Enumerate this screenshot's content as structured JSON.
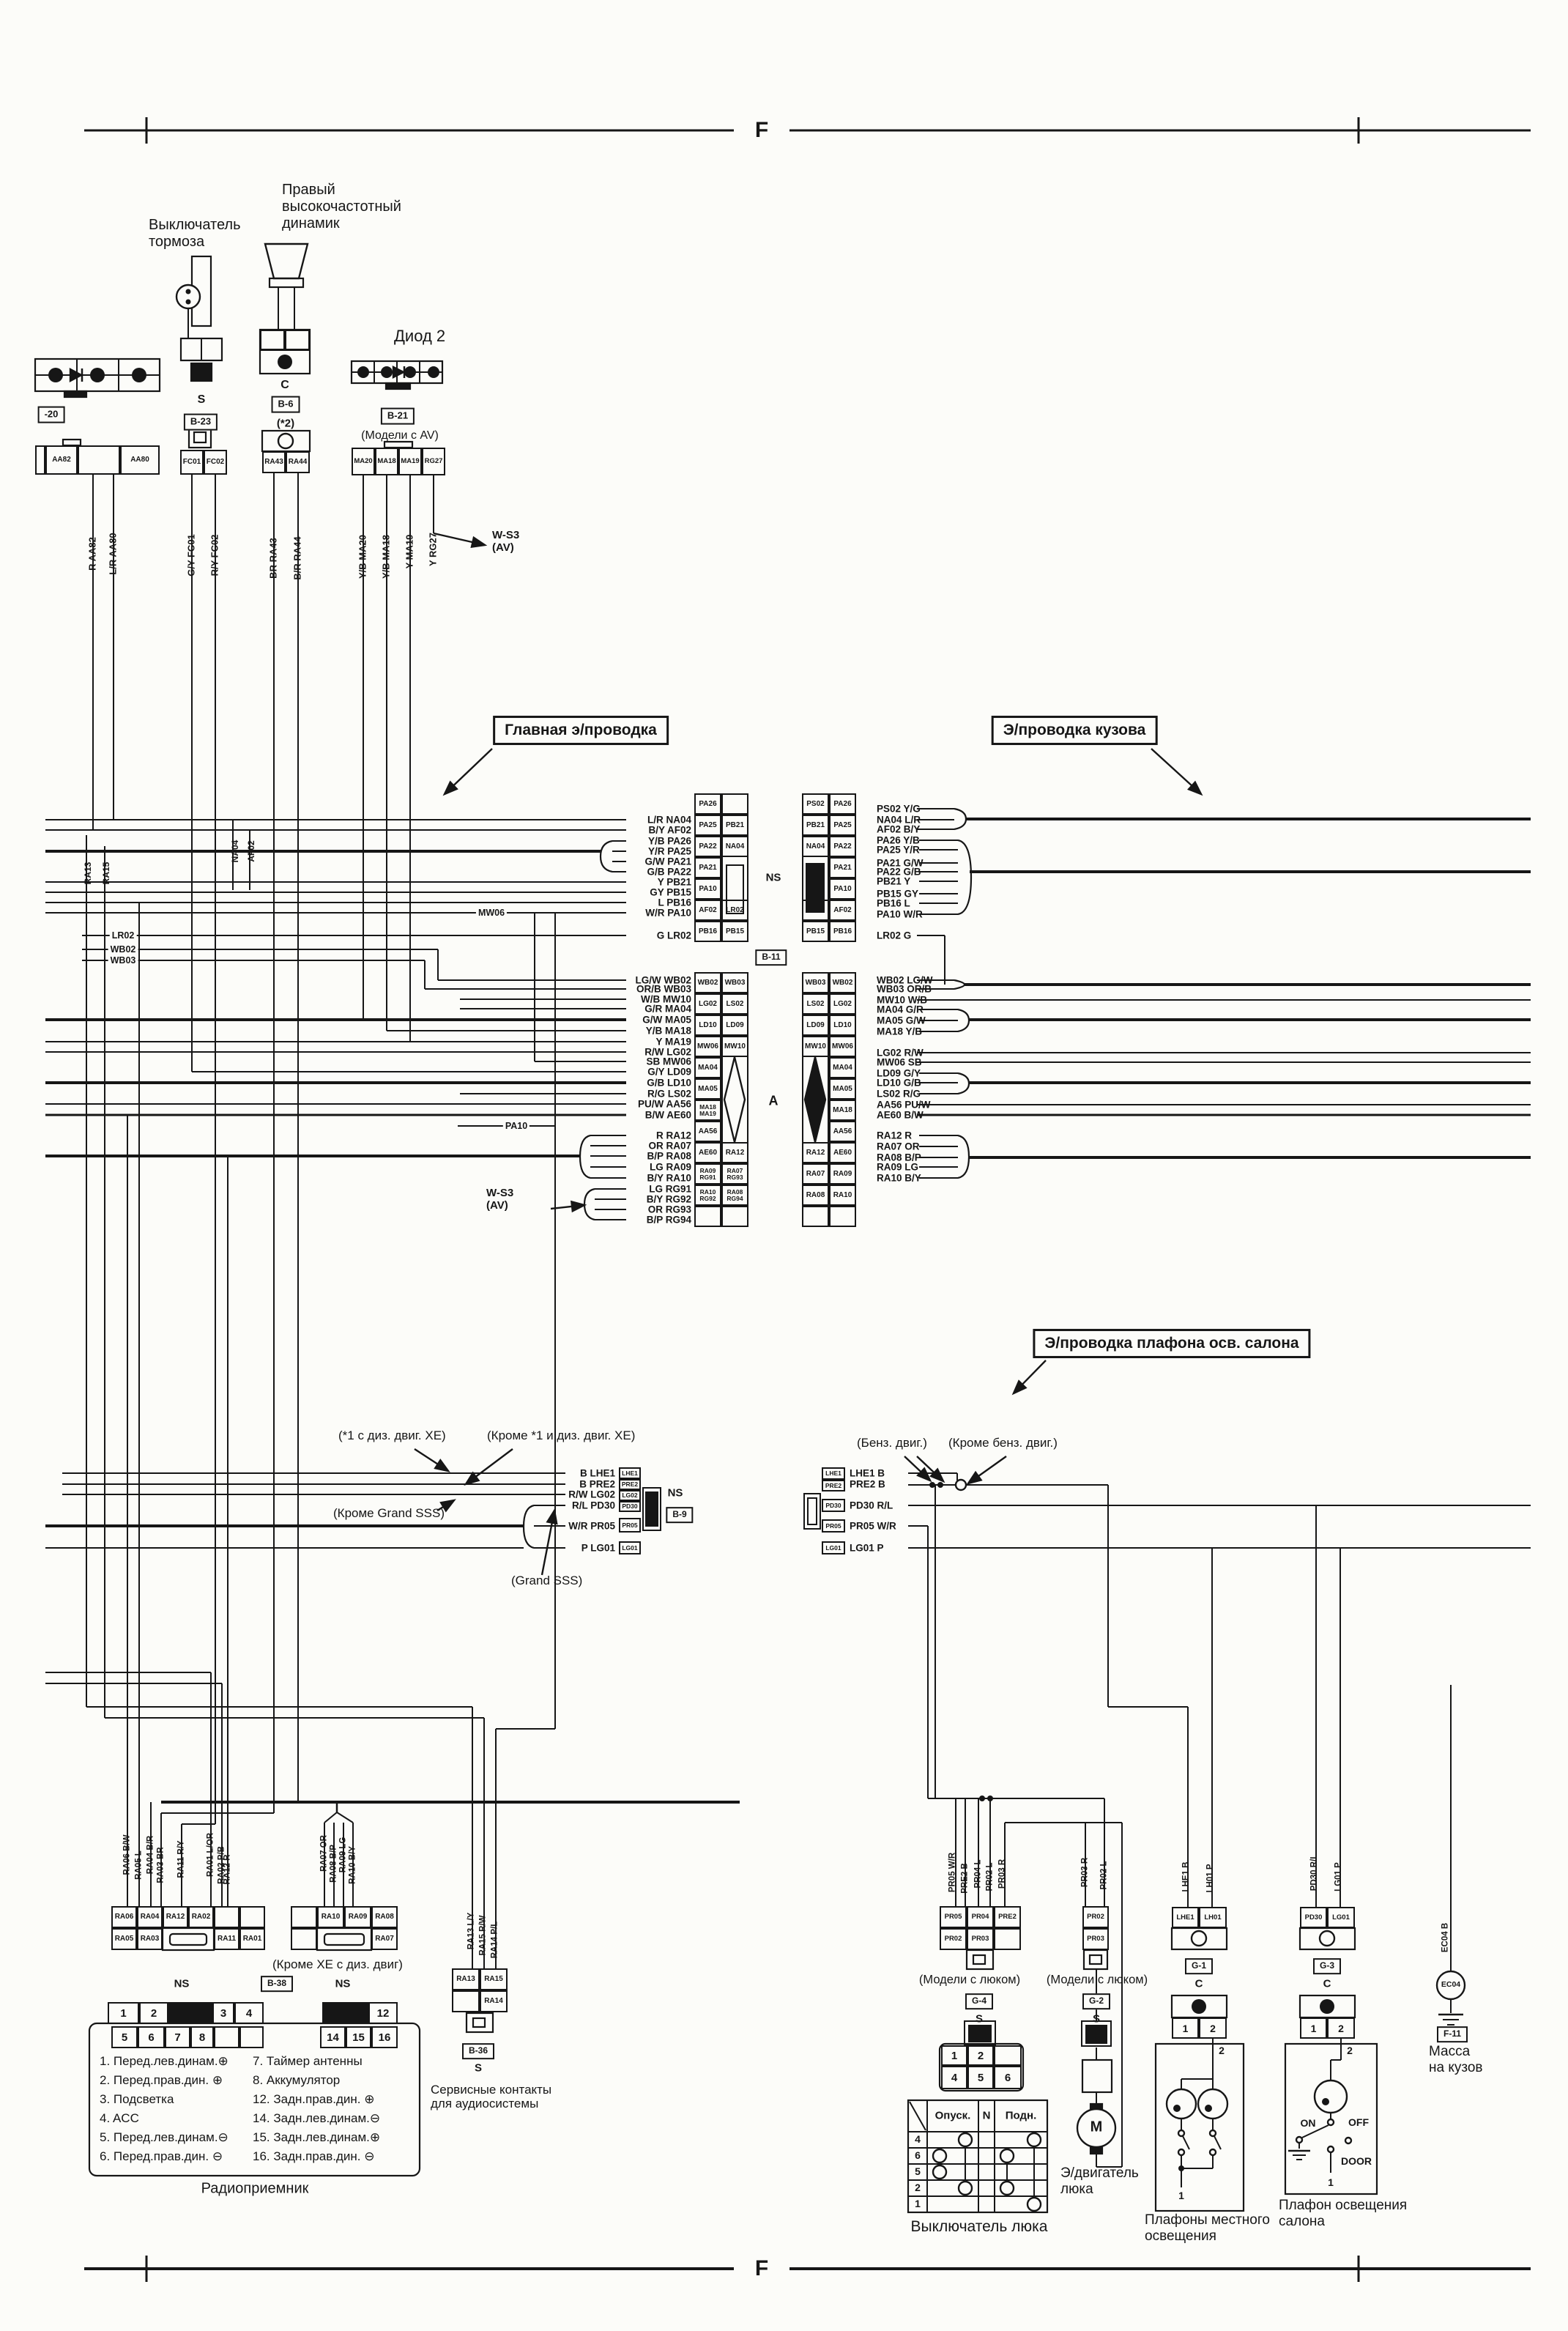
{
  "page": {
    "frame_letter": "F"
  },
  "sections": {
    "main": "Главная э/проводка",
    "body": "Э/проводка кузова",
    "dome": "Э/проводка плафона осв. салона"
  },
  "top": {
    "brake_switch": {
      "title": "Выключатель\nтормоза",
      "pin": "S",
      "conn_id": "B-23",
      "cells": [
        "FC01",
        "FC02"
      ],
      "wires": [
        "G/Y FC01",
        "R/Y FC02"
      ]
    },
    "tweeter": {
      "title": "Правый\nвысокочастотный\nдинамик",
      "pin": "C",
      "conn_id": "B-6",
      "note": "(*2)",
      "cells": [
        "RA43",
        "RA44"
      ],
      "wires": [
        "BR RA43",
        "B/R RA44"
      ]
    },
    "diode2": {
      "title": "Диод 2",
      "conn_id": "B-21",
      "note": "(Модели с AV)",
      "cells": [
        "MA20",
        "MA18",
        "MA19",
        "RG27"
      ],
      "wires": [
        "Y/B MA20",
        "Y/B MA18",
        "Y MA19",
        "Y RG27"
      ],
      "ws3": "W-S3\n(AV)"
    },
    "edge": {
      "conn_id": "-20",
      "cells": [
        "AA82",
        "",
        "AA80"
      ],
      "wires": [
        "R AA82",
        "L/R AA80"
      ]
    }
  },
  "main": {
    "ns": "NS",
    "b11": "B-11",
    "a": "A",
    "left_top": [
      "L/R NA04",
      "B/Y AF02",
      "Y/B PA26",
      "Y/R PA25",
      "G/W PA21",
      "G/B PA22",
      "Y PB21",
      "GY PB15",
      "L PB16",
      "W/R PA10"
    ],
    "mw06": "MW06",
    "g_lr02": "G LR02",
    "pa10": "PA10",
    "left_mid": [
      "LG/W WB02",
      "OR/B WB03",
      "W/B MW10",
      "G/R MA04",
      "G/W MA05",
      "Y/B MA18",
      "Y MA19",
      "R/W LG02",
      "SB MW06",
      "G/Y LD09",
      "G/B LD10",
      "R/G LS02",
      "PU/W AA56",
      "B/W AE60"
    ],
    "left_ra": [
      "R RA12",
      "OR RA07",
      "B/P RA08",
      "LG RA09",
      "B/Y RA10"
    ],
    "left_rg": [
      "LG RG91",
      "B/Y RG92",
      "OR RG93",
      "B/P RG94"
    ],
    "ws3": "W-S3\n(AV)",
    "edge_labels": [
      "LR02",
      "WB02",
      "WB03"
    ],
    "riser_labels": [
      "NA04",
      "AF02",
      "RA13",
      "RA15"
    ],
    "grid_left_top": [
      [
        "PA26",
        ""
      ],
      [
        "PA25",
        "PB21"
      ],
      [
        "PA22",
        "NA04"
      ],
      [
        "PA21",
        ""
      ],
      [
        "PA10",
        ""
      ],
      [
        "AF02",
        "LR02"
      ],
      [
        "PB16",
        "PB15"
      ]
    ],
    "grid_right_top": [
      [
        "PS02",
        "PA26"
      ],
      [
        "PB21",
        "PA25"
      ],
      [
        "NA04",
        "PA22"
      ],
      [
        "",
        "PA21"
      ],
      [
        "",
        "PA10"
      ],
      [
        "LR02",
        "AF02"
      ],
      [
        "PB15",
        "PB16"
      ]
    ],
    "grid_left_mid": [
      [
        "WB02",
        "WB03"
      ],
      [
        "LG02",
        "LS02"
      ],
      [
        "LD10",
        "LD09"
      ],
      [
        "MW06",
        "MW10"
      ],
      [
        "MA04",
        ""
      ],
      [
        "MA05",
        ""
      ],
      [
        "MA18 MA19",
        ""
      ],
      [
        "AA56",
        ""
      ],
      [
        "AE60",
        "RA12"
      ],
      [
        "RA09 RG91",
        "RA07 RG93"
      ],
      [
        "RA10 RG92",
        "RA08 RG94"
      ]
    ],
    "grid_right_mid": [
      [
        "WB03",
        "WB02"
      ],
      [
        "LS02",
        "LG02"
      ],
      [
        "LD09",
        "LD10"
      ],
      [
        "MW10",
        "MW06"
      ],
      [
        "",
        "MA04"
      ],
      [
        "",
        "MA05"
      ],
      [
        "",
        "MA18"
      ],
      [
        "",
        "AA56"
      ],
      [
        "RA12",
        "AE60"
      ],
      [
        "RA07",
        "RA09"
      ],
      [
        "RA08",
        "RA10"
      ]
    ],
    "right_top": [
      "PS02 Y/G",
      "NA04 L/R",
      "AF02 B/Y",
      "PA26 Y/B",
      "PA25 Y/R",
      "PA21 G/W",
      "PA22 G/B",
      "PB21 Y",
      "PB15 GY",
      "PB16 L",
      "PA10 W/R",
      "LR02 G"
    ],
    "right_mid": [
      "WB02 LG/W",
      "WB03 OR/B",
      "MW10 W/B",
      "MA04 G/R",
      "MA05 G/W",
      "MA18 Y/B",
      "LG02 R/W",
      "MW06 SB",
      "LD09 G/Y",
      "LD10 G/B",
      "LS02 R/G",
      "AA56 PU/W",
      "AE60 B/W"
    ],
    "right_ra": [
      "RA12 R",
      "RA07 OR",
      "RA08 B/P",
      "RA09 LG",
      "RA10 B/Y"
    ]
  },
  "dome": {
    "notes": {
      "n1": "(*1 с диз. двиг. XE)",
      "n2": "(Кроме *1 и диз. двиг. XE)",
      "n3": "(Кроме Grand SSS)",
      "n4": "(Grand SSS)",
      "n5": "(Бенз. двиг.)",
      "n6": "(Кроме бенз. двиг.)"
    },
    "ns": "NS",
    "b9": "B-9",
    "left_list": [
      "B LHE1",
      "B PRE2",
      "R/W LG02",
      "R/L PD30",
      "W/R PR05",
      "P LG01"
    ],
    "left_strip": [
      "LHE1",
      "PRE2",
      "LG02",
      "PD30",
      "PR05",
      "LG01"
    ],
    "right_strip": [
      "LHE1",
      "PRE2",
      "PD30",
      "PR05",
      "LG01"
    ],
    "right_list": [
      "LHE1 B",
      "PRE2 B",
      "PD30 R/L",
      "PR05 W/R",
      "LG01 P"
    ]
  },
  "radio": {
    "wires_left": [
      "RA06 B/W",
      "RA05 L",
      "RA04 B/R",
      "RA03 BR",
      "RA11 R/Y",
      "RA01 L/OR",
      "RA02 P/B",
      "RA12 R"
    ],
    "wires_right": [
      "RA07 OR",
      "RA08 B/P",
      "RA09 LG",
      "RA10 B/Y"
    ],
    "conn_left_r1": [
      "RA06",
      "RA04",
      "RA12",
      "RA02",
      "",
      ""
    ],
    "conn_left_r2": [
      "RA05",
      "RA03",
      "RA11",
      "RA01"
    ],
    "conn_right_r1": [
      "RA10",
      "RA09",
      "RA08"
    ],
    "conn_right_r2": [
      "RA07"
    ],
    "note": "(Кроме XE с диз. двиг)",
    "ns1": "NS",
    "b38": "B-38",
    "ns2": "NS",
    "pins_r1": [
      "1",
      "2",
      "3",
      "4"
    ],
    "pin12": "12",
    "pins_r2": [
      "5",
      "6",
      "7",
      "8"
    ],
    "pins_r2b": [
      "14",
      "15",
      "16"
    ],
    "legend_col1": [
      "1. Перед.лев.динам.⊕",
      "2. Перед.прав.дин. ⊕",
      "3. Подсветка",
      "4. ACC",
      "5. Перед.лев.динам.⊖",
      "6. Перед.прав.дин. ⊖"
    ],
    "legend_col2": [
      "7. Таймер антенны",
      "8. Аккумулятор",
      "12. Задн.прав.дин. ⊕",
      "14. Задн.лев.динам.⊖",
      "15. Задн.лев.динам.⊕",
      "16. Задн.прав.дин. ⊖"
    ],
    "caption": "Радиоприемник"
  },
  "service": {
    "wires": [
      "RA13 L/Y",
      "RA15 R/W",
      "RA14 P/L"
    ],
    "cells_r1": [
      "RA13",
      "RA15"
    ],
    "cell_r2": "RA14",
    "b36": "B-36",
    "s": "S",
    "caption": "Сервисные контакты\nдля аудиосистемы"
  },
  "sunroof_switch": {
    "wires": [
      "PR05 W/R",
      "PRE2 B",
      "PR04 L",
      "PR02 L",
      "PR03 R"
    ],
    "conn_r1": [
      "PR05",
      "PR04",
      "PRE2"
    ],
    "conn_r2": [
      "PR02",
      "PR03",
      ""
    ],
    "note": "(Модели с люком)",
    "id": "G-4",
    "s": "S",
    "pins_r1": [
      "1",
      "2"
    ],
    "pins_r2": [
      "4",
      "5",
      "6"
    ],
    "tbl_heads": [
      "Опуск.",
      "N",
      "Подн."
    ],
    "tbl_rows": [
      "4",
      "6",
      "5",
      "2",
      "1"
    ],
    "caption": "Выключатель люка"
  },
  "sunroof_motor": {
    "wires": [
      "PR03 R",
      "PR02 L"
    ],
    "cells": [
      "PR02",
      "PR03"
    ],
    "note": "(Модели с люком)",
    "id": "G-2",
    "s": "S",
    "m": "M",
    "caption": "Э/двигатель\nлюка"
  },
  "map_lamps": {
    "wires": [
      "LHE1 B",
      "LH01 P"
    ],
    "cells": [
      "LHE1",
      "LH01"
    ],
    "id": "G-1",
    "c": "C",
    "pins": [
      "1",
      "2"
    ],
    "p2": "2",
    "p1": "1",
    "caption": "Плафоны местного\nосвещения"
  },
  "dome_lamp": {
    "wires": [
      "PD30 R/L",
      "LG01 P"
    ],
    "cells": [
      "PD30",
      "LG01"
    ],
    "id": "G-3",
    "c": "C",
    "pins": [
      "1",
      "2"
    ],
    "p2": "2",
    "p1": "1",
    "on": "ON",
    "off": "OFF",
    "door": "DOOR",
    "caption": "Плафон освещения\nсалона"
  },
  "ground": {
    "wire": "EC04 B",
    "circle": "EC04",
    "id": "F-11",
    "caption": "Масса\nна кузов"
  }
}
